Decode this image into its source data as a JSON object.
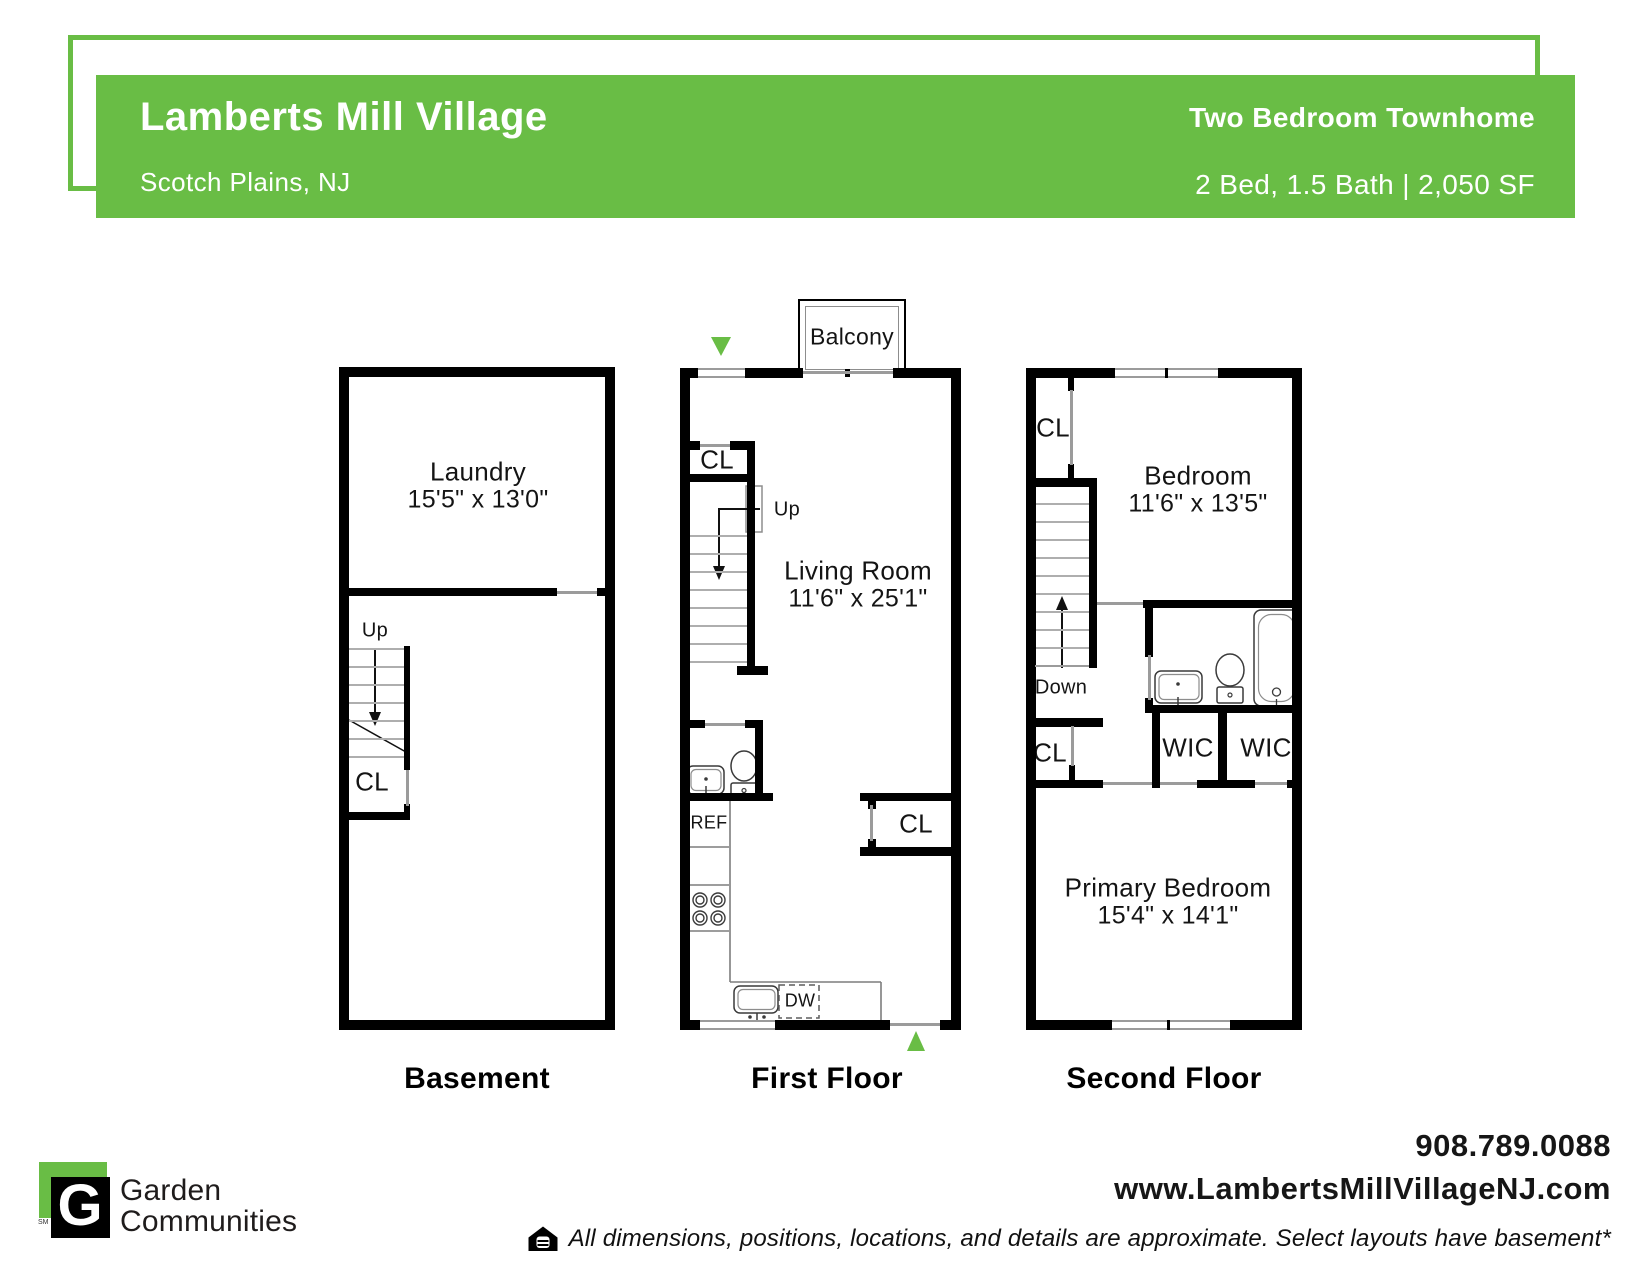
{
  "colors": {
    "brand_green": "#69bd45",
    "wall_black": "#000000"
  },
  "header": {
    "title": "Lamberts Mill Village",
    "location": "Scotch Plains, NJ",
    "plan_name": "Two Bedroom Townhome",
    "plan_specs": "2 Bed, 1.5 Bath | 2,050 SF"
  },
  "floors": {
    "basement": {
      "label": "Basement",
      "laundry": {
        "name": "Laundry",
        "dims": "15'5\" x 13'0\""
      },
      "up": "Up",
      "closet": "CL"
    },
    "first": {
      "label": "First Floor",
      "balcony": "Balcony",
      "closet_top": "CL",
      "up": "Up",
      "living": {
        "name": "Living Room",
        "dims": "11'6\" x 25'1\""
      },
      "fridge": "REF",
      "dishwasher": "DW",
      "closet_right": "CL"
    },
    "second": {
      "label": "Second Floor",
      "closet_top": "CL",
      "bedroom": {
        "name": "Bedroom",
        "dims": "11'6\" x 13'5\""
      },
      "down": "Down",
      "closet_mid": "CL",
      "wic_left": "WIC",
      "wic_right": "WIC",
      "primary": {
        "name": "Primary Bedroom",
        "dims": "15'4\" x 14'1\""
      }
    }
  },
  "footer": {
    "logo_letter": "G",
    "service_mark": "SM",
    "brand_line1": "Garden",
    "brand_line2": "Communities",
    "phone": "908.789.0088",
    "website": "www.LambertsMillVillageNJ.com",
    "disclaimer": "All dimensions, positions, locations, and details are approximate. Select layouts have basement*"
  }
}
